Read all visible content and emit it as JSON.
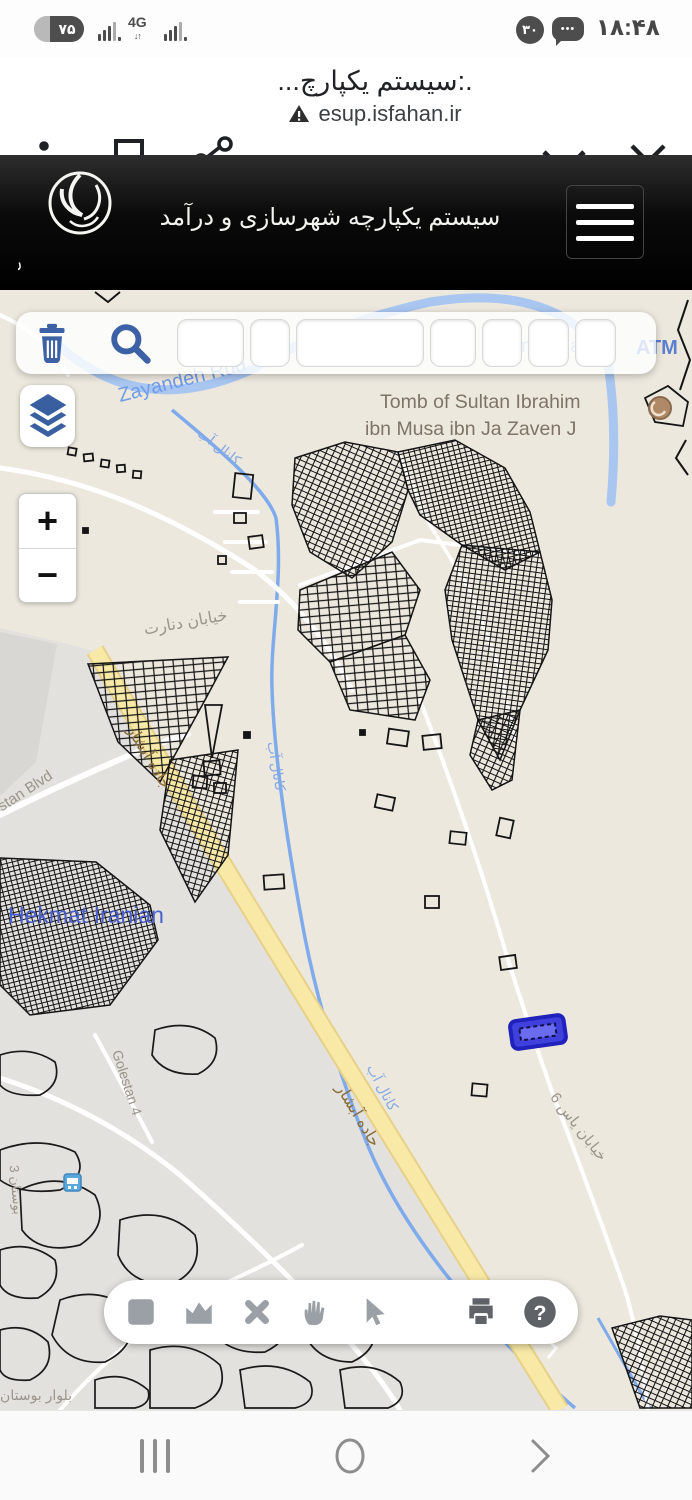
{
  "status_bar": {
    "battery_percent": "۷۵",
    "network_type": "4G",
    "notification_count": "۳۰",
    "time": "۱۸:۴۸"
  },
  "browser": {
    "page_title": ".:سیستم یکپارچ...",
    "url": "esup.isfahan.ir"
  },
  "app_header": {
    "title": "سیستم یکپارچه شهرسازی و درآمد",
    "logo_text": "شهرداری اصفهان"
  },
  "map": {
    "labels": {
      "river": "Zayandeh Rud",
      "tomb_line1": "Tomb of Sultan Ibrahim",
      "tomb_line2": "ibn Musa ibn Ja Zaven J",
      "poi_bank": "Saman Bank",
      "poi_atm": "ATM",
      "st_denart": "خیابان دنارت",
      "canal": "کانال آب",
      "rd_abshar": "جاده آبشار",
      "blvd_golestan": "lestan Blvd",
      "neighborhood": "Hekmat Iranian",
      "st_golestan4": "Golestan 4",
      "blvd_bustan3": "بلوار بوستان 3",
      "st_yas6": "خیابان یاس 6",
      "st_bustan_edge": "بوستان 3"
    },
    "colors": {
      "background": "#ece8de",
      "zone_gray": "#e3e1dd",
      "water": "#a8c6f0",
      "road_major": "#f8e9a6",
      "parcel_line": "#141414",
      "selected_parcel": "#4040dd",
      "icon_blue": "#3c61a5"
    }
  },
  "map_toolbar": {
    "icons": [
      "trash-icon",
      "search-icon"
    ],
    "field_values": [
      "",
      "",
      "",
      "",
      "",
      "",
      ""
    ]
  },
  "zoom_control": {
    "zoom_in": "+",
    "zoom_out": "−"
  },
  "bottom_toolbar": {
    "icons": [
      "rect-select",
      "measure-area",
      "clear",
      "pan",
      "pointer",
      "print",
      "help"
    ],
    "help_glyph": "?"
  },
  "nav_bar": {
    "icons": [
      "recents",
      "home",
      "back"
    ]
  }
}
